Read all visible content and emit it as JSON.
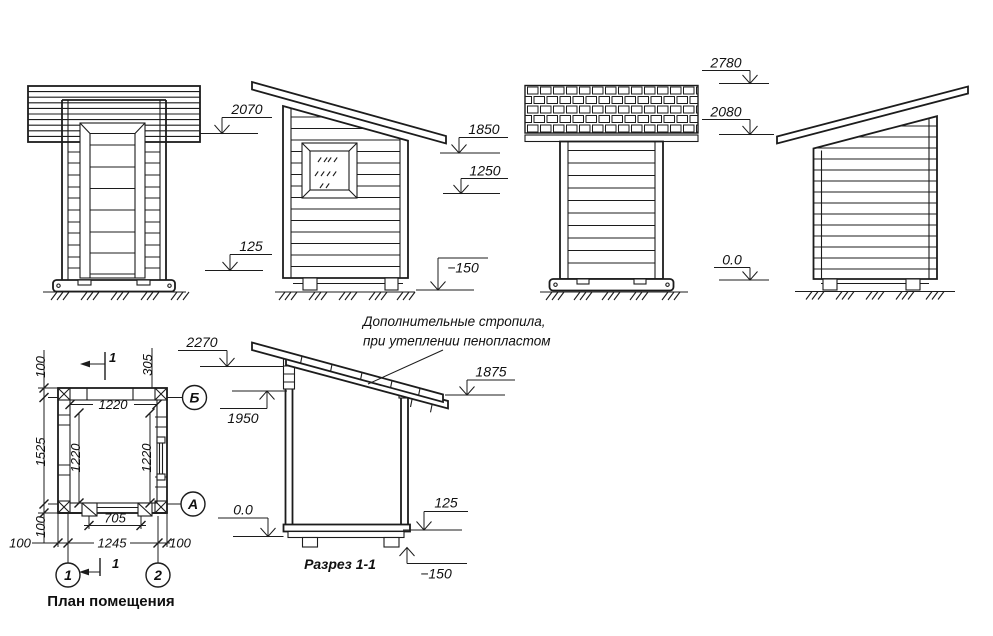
{
  "page": {
    "background": "#ffffff",
    "ink": "#1c1c1c"
  },
  "elevation_front": {
    "levels": {
      "roof": "2070",
      "plinth": "125"
    }
  },
  "elevation_left": {
    "levels": {
      "eaves": "1850",
      "window": "1250",
      "ground": "−150"
    }
  },
  "elevation_rear": {
    "levels": {
      "ridge": "2780",
      "eaves": "2080",
      "zero": "0.0"
    }
  },
  "plan": {
    "title": "План помещения",
    "axes": {
      "row_top": "Б",
      "row_bottom": "А",
      "col_left": "1",
      "col_right": "2"
    },
    "cut_label": "1",
    "dims": {
      "offset_top": "100",
      "height_axes": "1525",
      "offset_bottom": "100",
      "inner_width": "1220",
      "inner_left": "1220",
      "inner_right": "1220",
      "door_width": "705",
      "width_axes": "1245",
      "margin_left": "100",
      "margin_right": "100",
      "roof_edge": "305"
    }
  },
  "section": {
    "title": "Разрез 1-1",
    "note_line1": "Дополнительные стропила,",
    "note_line2": "при утеплении пенопластом",
    "levels": {
      "ridge": "2270",
      "wall_top": "1950",
      "eaves": "1875",
      "zero": "0.0",
      "floor": "125",
      "ground": "−150"
    }
  }
}
